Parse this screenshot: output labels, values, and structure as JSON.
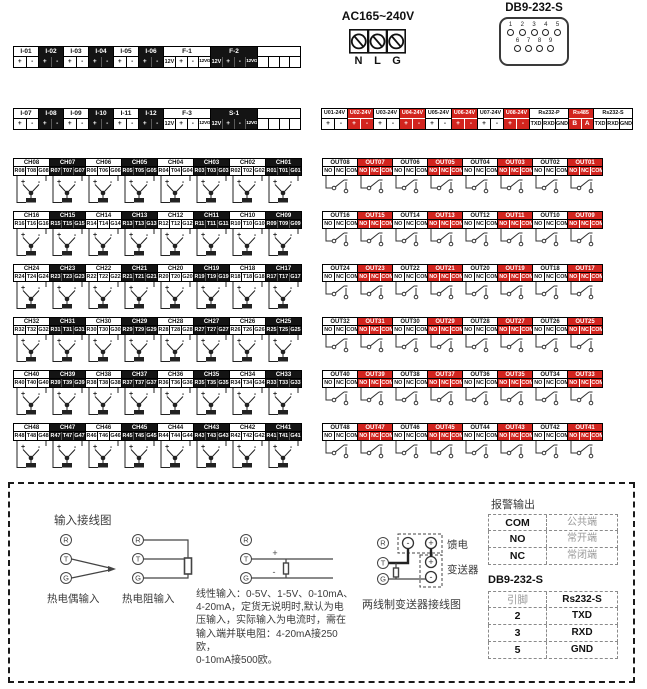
{
  "power": {
    "label": "AC165~240V",
    "terminals": [
      "N",
      "L",
      "G"
    ]
  },
  "db9_connector": {
    "label": "DB9-232-S",
    "top_pins": [
      "1",
      "2",
      "3",
      "4",
      "5"
    ],
    "bottom_pins": [
      "6",
      "7",
      "8",
      "9"
    ]
  },
  "strips": {
    "row1": [
      {
        "label": "I-01",
        "cells": [
          "+",
          "-"
        ],
        "s": "light",
        "w": 26
      },
      {
        "label": "I-02",
        "cells": [
          "+",
          "-"
        ],
        "s": "dark",
        "w": 26
      },
      {
        "label": "I-03",
        "cells": [
          "+",
          "-"
        ],
        "s": "light",
        "w": 26
      },
      {
        "label": "I-04",
        "cells": [
          "+",
          "-"
        ],
        "s": "dark",
        "w": 26
      },
      {
        "label": "I-05",
        "cells": [
          "+",
          "-"
        ],
        "s": "light",
        "w": 26
      },
      {
        "label": "I-06",
        "cells": [
          "+",
          "-"
        ],
        "s": "dark",
        "w": 26
      },
      {
        "label": "F-1",
        "cells": [
          "12V",
          "+",
          "-",
          "12VG"
        ],
        "s": "light",
        "w": 48
      },
      {
        "label": "F-2",
        "cells": [
          "12V",
          "+",
          "-",
          "12VG"
        ],
        "s": "dark",
        "w": 48
      },
      {
        "label": "",
        "cells": [
          "",
          "",
          "",
          ""
        ],
        "s": "light",
        "w": 44
      }
    ],
    "row2": [
      {
        "label": "I-07",
        "cells": [
          "+",
          "-"
        ],
        "s": "light",
        "w": 26
      },
      {
        "label": "I-08",
        "cells": [
          "+",
          "-"
        ],
        "s": "dark",
        "w": 26
      },
      {
        "label": "I-09",
        "cells": [
          "+",
          "-"
        ],
        "s": "light",
        "w": 26
      },
      {
        "label": "I-10",
        "cells": [
          "+",
          "-"
        ],
        "s": "dark",
        "w": 26
      },
      {
        "label": "I-11",
        "cells": [
          "+",
          "-"
        ],
        "s": "light",
        "w": 26
      },
      {
        "label": "I-12",
        "cells": [
          "+",
          "-"
        ],
        "s": "dark",
        "w": 26
      },
      {
        "label": "F-3",
        "cells": [
          "12V",
          "+",
          "-",
          "12VG"
        ],
        "s": "light",
        "w": 48
      },
      {
        "label": "S-1",
        "cells": [
          "12V",
          "+",
          "-",
          "12VG"
        ],
        "s": "dark",
        "w": 48
      },
      {
        "label": "",
        "cells": [
          "",
          "",
          "",
          ""
        ],
        "s": "light",
        "w": 44
      }
    ],
    "u_row": [
      {
        "label": "U01-24V",
        "cells": [
          "+",
          "-"
        ],
        "s": "light",
        "w": 27
      },
      {
        "label": "U02-24V",
        "cells": [
          "+",
          "-"
        ],
        "s": "red",
        "w": 27
      },
      {
        "label": "U03-24V",
        "cells": [
          "+",
          "-"
        ],
        "s": "light",
        "w": 27
      },
      {
        "label": "U04-24V",
        "cells": [
          "+",
          "-"
        ],
        "s": "red",
        "w": 27
      },
      {
        "label": "U05-24V",
        "cells": [
          "+",
          "-"
        ],
        "s": "light",
        "w": 27
      },
      {
        "label": "U06-24V",
        "cells": [
          "+",
          "-"
        ],
        "s": "red",
        "w": 27
      },
      {
        "label": "U07-24V",
        "cells": [
          "+",
          "-"
        ],
        "s": "light",
        "w": 27
      },
      {
        "label": "U08-24V",
        "cells": [
          "+",
          "-"
        ],
        "s": "red",
        "w": 27
      },
      {
        "label": "Rs232-P",
        "cells": [
          "TXD",
          "RXD",
          "GND"
        ],
        "s": "light",
        "w": 40
      },
      {
        "label": "Rs485",
        "cells": [
          "B",
          "A"
        ],
        "s": "red",
        "w": 26
      },
      {
        "label": "Rs232-S",
        "cells": [
          "TXD",
          "RXD",
          "GND"
        ],
        "s": "light",
        "w": 40
      }
    ]
  },
  "channels": {
    "rows": [
      [
        [
          "CH08",
          "R08",
          "T08",
          "G08"
        ],
        [
          "CH07",
          "R07",
          "T07",
          "G07"
        ],
        [
          "CH06",
          "R06",
          "T06",
          "G06"
        ],
        [
          "CH05",
          "R05",
          "T05",
          "G05"
        ],
        [
          "CH04",
          "R04",
          "T04",
          "G04"
        ],
        [
          "CH03",
          "R03",
          "T03",
          "G03"
        ],
        [
          "CH02",
          "R02",
          "T02",
          "G02"
        ],
        [
          "CH01",
          "R01",
          "T01",
          "G01"
        ]
      ],
      [
        [
          "CH16",
          "R16",
          "T16",
          "G16"
        ],
        [
          "CH15",
          "R15",
          "T15",
          "G15"
        ],
        [
          "CH14",
          "R14",
          "T14",
          "G14"
        ],
        [
          "CH13",
          "R13",
          "T13",
          "G13"
        ],
        [
          "CH12",
          "R12",
          "T12",
          "G12"
        ],
        [
          "CH11",
          "R11",
          "T11",
          "G11"
        ],
        [
          "CH10",
          "R10",
          "T10",
          "G10"
        ],
        [
          "CH09",
          "R09",
          "T09",
          "G09"
        ]
      ],
      [
        [
          "CH24",
          "R24",
          "T24",
          "G24"
        ],
        [
          "CH23",
          "R23",
          "T23",
          "G23"
        ],
        [
          "CH22",
          "R22",
          "T22",
          "G22"
        ],
        [
          "CH21",
          "R21",
          "T21",
          "G21"
        ],
        [
          "CH20",
          "R20",
          "T20",
          "G20"
        ],
        [
          "CH19",
          "R19",
          "T19",
          "G19"
        ],
        [
          "CH18",
          "R18",
          "T18",
          "G18"
        ],
        [
          "CH17",
          "R17",
          "T17",
          "G17"
        ]
      ],
      [
        [
          "CH32",
          "R32",
          "T32",
          "G32"
        ],
        [
          "CH31",
          "R31",
          "T31",
          "G31"
        ],
        [
          "CH30",
          "R30",
          "T30",
          "G30"
        ],
        [
          "CH29",
          "R29",
          "T29",
          "G29"
        ],
        [
          "CH28",
          "R28",
          "T28",
          "G28"
        ],
        [
          "CH27",
          "R27",
          "T27",
          "G27"
        ],
        [
          "CH26",
          "R26",
          "T26",
          "G26"
        ],
        [
          "CH25",
          "R25",
          "T25",
          "G25"
        ]
      ],
      [
        [
          "CH40",
          "R40",
          "T40",
          "G40"
        ],
        [
          "CH39",
          "R39",
          "T39",
          "G39"
        ],
        [
          "CH38",
          "R38",
          "T38",
          "G38"
        ],
        [
          "CH37",
          "R37",
          "T37",
          "G37"
        ],
        [
          "CH36",
          "R36",
          "T36",
          "G36"
        ],
        [
          "CH35",
          "R35",
          "T35",
          "G35"
        ],
        [
          "CH34",
          "R34",
          "T34",
          "G34"
        ],
        [
          "CH33",
          "R33",
          "T33",
          "G33"
        ]
      ],
      [
        [
          "CH48",
          "R48",
          "T48",
          "G48"
        ],
        [
          "CH47",
          "R47",
          "T47",
          "G47"
        ],
        [
          "CH46",
          "R46",
          "T46",
          "G46"
        ],
        [
          "CH45",
          "R45",
          "T45",
          "G45"
        ],
        [
          "CH44",
          "R44",
          "T44",
          "G44"
        ],
        [
          "CH43",
          "R43",
          "T43",
          "G43"
        ],
        [
          "CH42",
          "R42",
          "T42",
          "G42"
        ],
        [
          "CH41",
          "R41",
          "T41",
          "G41"
        ]
      ]
    ]
  },
  "outputs": {
    "cells": [
      "NO",
      "NC",
      "COM"
    ],
    "rows": [
      [
        "OUT08",
        "OUT07",
        "OUT06",
        "OUT05",
        "OUT04",
        "OUT03",
        "OUT02",
        "OUT01"
      ],
      [
        "OUT16",
        "OUT15",
        "OUT14",
        "OUT13",
        "OUT12",
        "OUT11",
        "OUT10",
        "OUT09"
      ],
      [
        "OUT24",
        "OUT23",
        "OUT22",
        "OUT21",
        "OUT20",
        "OUT19",
        "OUT18",
        "OUT17"
      ],
      [
        "OUT32",
        "OUT31",
        "OUT30",
        "OUT29",
        "OUT28",
        "OUT27",
        "OUT26",
        "OUT25"
      ],
      [
        "OUT40",
        "OUT39",
        "OUT38",
        "OUT37",
        "OUT36",
        "OUT35",
        "OUT34",
        "OUT33"
      ],
      [
        "OUT48",
        "OUT47",
        "OUT46",
        "OUT45",
        "OUT44",
        "OUT43",
        "OUT42",
        "OUT41"
      ]
    ]
  },
  "bottom": {
    "input_diagram_title": "输入接线图",
    "rtg": [
      "R",
      "T",
      "G"
    ],
    "plus": "+",
    "minus": "-",
    "thermocouple_label": "热电偶输入",
    "rtd_label": "热电阻输入",
    "linear_text": "线性输入：0-5V、1-5V、0-10mA、\n4-20mA，定货无说明时,默认为电\n压输入，实际输入为电流时，需在\n输入端并联电阻：4-20mA接250欧，\n0-10mA接500欧。",
    "transmitter_caption": "两线制变送器接线图",
    "feed_label": "馈电",
    "transducer_label": "变送器",
    "alarm_table": {
      "title": "报警输出",
      "rows": [
        [
          "COM",
          "公共端"
        ],
        [
          "NO",
          "常开端"
        ],
        [
          "NC",
          "常闭端"
        ]
      ]
    },
    "db9_table": {
      "title": "DB9-232-S",
      "rows": [
        [
          "引脚",
          "Rs232-S"
        ],
        [
          "2",
          "TXD"
        ],
        [
          "3",
          "RXD"
        ],
        [
          "5",
          "GND"
        ]
      ]
    }
  },
  "colors": {
    "accent_red": "#d2241e",
    "block_dark": "#141414"
  }
}
